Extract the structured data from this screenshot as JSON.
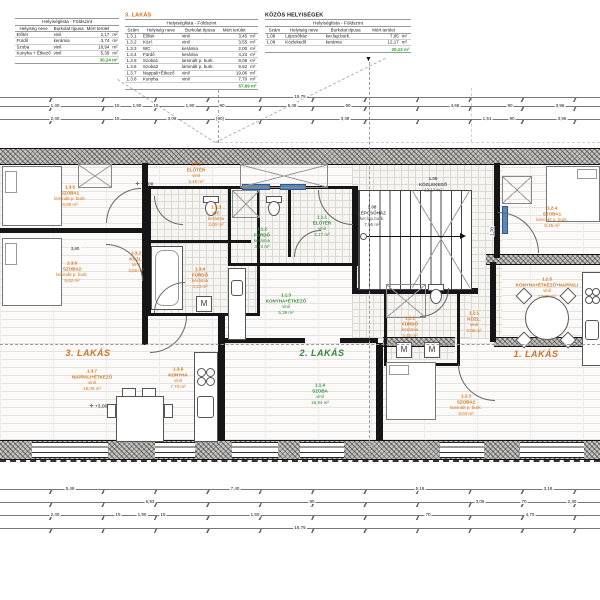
{
  "drawing": {
    "floor_name": "Földszint",
    "colors": {
      "accent_orange": "#d2711f",
      "accent_green": "#2e8b3a",
      "total_green": "#27a327",
      "wall_dark": "#161616",
      "glass_blue": "#5d86b8"
    },
    "tables": [
      {
        "title": "",
        "title_color": "dark",
        "header": "Helyiséglista - Földszint",
        "columns": [
          "Helyiség neve",
          "Burkolat típusa",
          "Mért terület",
          ""
        ],
        "rows": [
          [
            "Előtér",
            "vinil",
            "2,17",
            "m²"
          ],
          [
            "Fürdő",
            "kerámia",
            "3,74",
            "m²"
          ],
          [
            "Szoba",
            "vinil",
            "18,94",
            "m²"
          ],
          [
            "Konyha + Étkező",
            "vinil",
            "5,39",
            "m²"
          ]
        ],
        "total": "30,24 m²"
      },
      {
        "title": "3. LAKÁS",
        "title_color": "orange",
        "header": "Helyiséglista - Földszint",
        "columns": [
          "Szám",
          "Helyiség neve",
          "Burkolat típusa",
          "Mért terület",
          ""
        ],
        "rows": [
          [
            "1.3.1",
            "Előtér",
            "vinil",
            "3,45",
            "m²"
          ],
          [
            "1.3.2",
            "Közl.",
            "vinil",
            "3,55",
            "m²"
          ],
          [
            "1.3.3",
            "WC",
            "kerámia",
            "2,00",
            "m²"
          ],
          [
            "1.3.4",
            "Fürdő",
            "kerámia",
            "4,23",
            "m²"
          ],
          [
            "1.3.5",
            "Szoba1",
            "laminált p. burk.",
            "8,08",
            "m²"
          ],
          [
            "1.3.6",
            "Szoba2",
            "laminált p. burk.",
            "9,62",
            "m²"
          ],
          [
            "1.3.7",
            "Nappali+Étkező",
            "vinil",
            "19,06",
            "m²"
          ],
          [
            "1.3.8",
            "Konyha",
            "vinil",
            "7,70",
            "m²"
          ]
        ],
        "total": "57,69 m²"
      },
      {
        "title": "KÖZÖS HELYISÉGEK",
        "title_color": "dark",
        "header": "Helyiséglista - Földszint",
        "columns": [
          "Szám",
          "Helyiség neve",
          "Burkolat típusa",
          "Mért terület",
          ""
        ],
        "rows": [
          [
            "1.08",
            "Lépcsőház",
            "ker.lap.burk.",
            "7,95",
            "m²"
          ],
          [
            "1.09",
            "Közlekedő",
            "kerámia",
            "12,17",
            "m²"
          ]
        ],
        "total": "20,12 m²"
      }
    ],
    "plan": {
      "apartment_titles": [
        {
          "x": 88,
          "y": 353,
          "text": "3. LAKÁS",
          "color": "orange"
        },
        {
          "x": 322,
          "y": 353,
          "text": "2. LAKÁS",
          "color": "green"
        },
        {
          "x": 536,
          "y": 354,
          "text": "1. LAKÁS",
          "color": "orange"
        }
      ],
      "room_labels": [
        {
          "x": 70,
          "y": 196,
          "c": "o",
          "lines": [
            "1.3.5",
            "SZOBA1",
            "laminált p. burk.",
            "8,08 m²"
          ]
        },
        {
          "x": 72,
          "y": 272,
          "c": "o",
          "lines": [
            "1.3.6",
            "SZOBA2",
            "laminált p. burk.",
            "9,62 m²"
          ]
        },
        {
          "x": 136,
          "y": 262,
          "c": "o",
          "lines": [
            "1.3.2",
            "KÖZL.",
            "vinil",
            "3,55 m²"
          ]
        },
        {
          "x": 196,
          "y": 173,
          "c": "o",
          "lines": [
            "1.3.1",
            "ELŐTÉR",
            "vinil",
            "3,45 m²"
          ]
        },
        {
          "x": 216,
          "y": 216,
          "c": "o",
          "lines": [
            "1.3.3",
            "WC",
            "kerámia",
            "2,00 m²"
          ]
        },
        {
          "x": 200,
          "y": 278,
          "c": "o",
          "lines": [
            "1.3.4",
            "FÜRDŐ",
            "kerámia",
            "4,23 m²"
          ]
        },
        {
          "x": 92,
          "y": 380,
          "c": "o",
          "lines": [
            "1.3.7",
            "NAPPALI+ÉTKEZŐ",
            "vinil",
            "19,06 m²"
          ]
        },
        {
          "x": 178,
          "y": 378,
          "c": "o",
          "lines": [
            "1.3.8",
            "KONYHA",
            "vinil",
            "7,70 m²"
          ]
        },
        {
          "x": 262,
          "y": 238,
          "c": "g",
          "lines": [
            "1.1.2",
            "FÜRDŐ",
            "kerámia",
            "3,74 m²"
          ]
        },
        {
          "x": 322,
          "y": 226,
          "c": "g",
          "lines": [
            "1.1.1",
            "ELŐTÉR",
            "vinil",
            "2,17 m²"
          ]
        },
        {
          "x": 286,
          "y": 304,
          "c": "g",
          "lines": [
            "1.1.3",
            "KONYHA+ÉTKEZŐ",
            "vinil",
            "5,39 m²"
          ]
        },
        {
          "x": 320,
          "y": 394,
          "c": "g",
          "lines": [
            "1.1.4",
            "SZOBA",
            "vinil",
            "18,94 m²"
          ]
        },
        {
          "x": 552,
          "y": 217,
          "c": "o",
          "lines": [
            "1.2.4",
            "SZOBA1",
            "laminált p. burk.",
            "8,45 m²"
          ]
        },
        {
          "x": 410,
          "y": 327,
          "c": "o",
          "lines": [
            "1.2.2",
            "FÜRDŐ",
            "kerámia",
            "4,45 m²"
          ]
        },
        {
          "x": 474,
          "y": 322,
          "c": "o",
          "lines": [
            "1.2.1",
            "KÖZL.",
            "vinil",
            "3,06 m²"
          ]
        },
        {
          "x": 466,
          "y": 405,
          "c": "o",
          "lines": [
            "1.2.3",
            "SZOBA2",
            "laminált p. burk.",
            "8,03 m²"
          ]
        },
        {
          "x": 547,
          "y": 288,
          "c": "o",
          "lines": [
            "1.2.5",
            "KONYHA+ÉTKEZŐ+NAPPALI",
            "vinil",
            "17,27 m²"
          ]
        },
        {
          "x": 372,
          "y": 216,
          "c": "k",
          "lines": [
            "1.08",
            "LÉPCSŐHÁZ",
            "ker.lap.burk.",
            "7,95 m²"
          ]
        },
        {
          "x": 433,
          "y": 185,
          "c": "k",
          "lines": [
            "1.09",
            "KÖZLEKEDŐ",
            "12,17 m²"
          ]
        }
      ],
      "elevation_markers": [
        {
          "x": 128,
          "y": 184,
          "text": "+3,00"
        },
        {
          "x": 82,
          "y": 406,
          "text": "+3,00"
        }
      ],
      "machine_label": "M",
      "windows": [
        {
          "x": 32,
          "w": 76
        },
        {
          "x": 155,
          "w": 40
        },
        {
          "x": 232,
          "w": 46
        },
        {
          "x": 300,
          "w": 44
        },
        {
          "x": 440,
          "w": 44
        },
        {
          "x": 520,
          "w": 64
        }
      ]
    },
    "dimensions": {
      "top_chains": [
        {
          "y": 97,
          "values": [
            [
              300,
              "15,75"
            ]
          ]
        },
        {
          "y": 106,
          "values": [
            [
              55,
              "1,40"
            ],
            [
              117,
              "15"
            ],
            [
              137,
              "1,90"
            ],
            [
              156,
              "15"
            ],
            [
              190,
              "1,90"
            ],
            [
              222,
              "90"
            ],
            [
              292,
              "5,49"
            ],
            [
              348,
              "90"
            ],
            [
              455,
              "4,68"
            ],
            [
              510,
              "90"
            ],
            [
              560,
              "3,96"
            ]
          ]
        },
        {
          "y": 119,
          "values": [
            [
              55,
              "2,40"
            ],
            [
              117,
              "15"
            ],
            [
              172,
              "3,08"
            ],
            [
              220,
              "(90)"
            ],
            [
              345,
              "3,38"
            ],
            [
              487,
              "1,51"
            ],
            [
              512,
              "90"
            ],
            [
              562,
              "3,96"
            ]
          ]
        }
      ],
      "bottom_chains": [
        {
          "y": 489,
          "values": [
            [
              70,
              "5,49"
            ],
            [
              235,
              "7,40"
            ],
            [
              420,
              "5,18"
            ],
            [
              548,
              "3,18"
            ]
          ]
        },
        {
          "y": 502,
          "values": [
            [
              150,
              "6,93"
            ],
            [
              312,
              "90"
            ],
            [
              480,
              "3,05"
            ],
            [
              524,
              "70"
            ],
            [
              572,
              "2,30"
            ]
          ]
        },
        {
          "y": 515,
          "values": [
            [
              55,
              "2,40"
            ],
            [
              118,
              "15"
            ],
            [
              142,
              "1,90"
            ],
            [
              163,
              "15"
            ],
            [
              255,
              "1,50"
            ],
            [
              428,
              "70"
            ],
            [
              530,
              "4,70"
            ]
          ]
        },
        {
          "y": 528,
          "values": [
            [
              300,
              "15,75"
            ]
          ]
        }
      ],
      "interior": [
        {
          "x": 75,
          "y": 249,
          "text": "3,80",
          "vertical": false
        },
        {
          "x": 492,
          "y": 232,
          "text": "1,70",
          "vertical": true
        }
      ]
    }
  }
}
